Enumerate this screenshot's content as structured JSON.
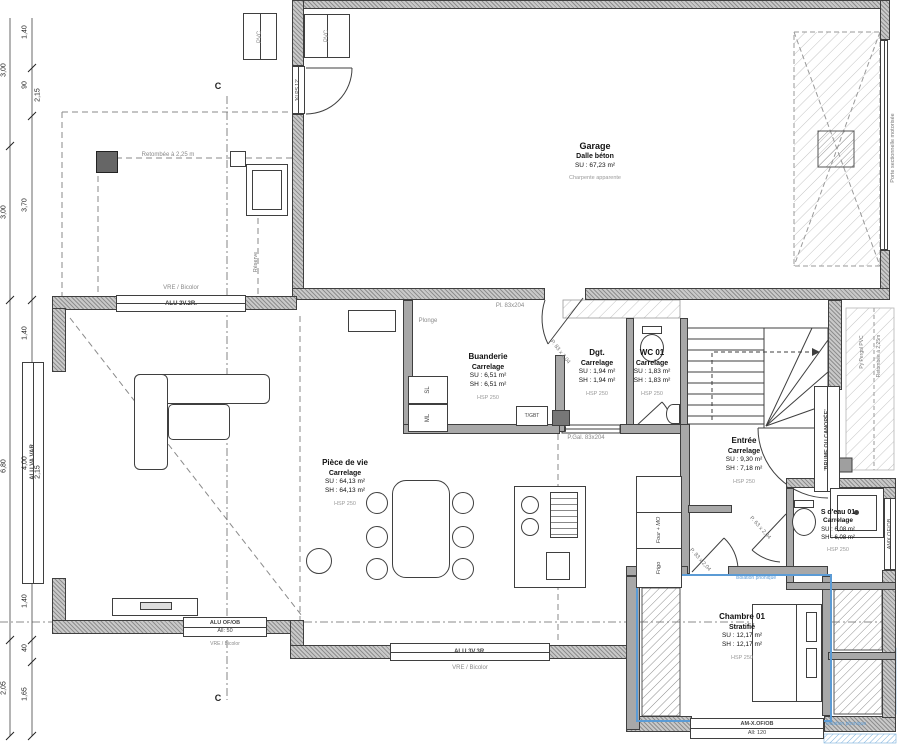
{
  "palette": {
    "wall_gray": "#a8a8a8",
    "line": "#3f3f3f",
    "accent_blue": "#5b9bd5",
    "hatch_gray": "#bdbdbd"
  },
  "rooms": [
    {
      "name": "Garage",
      "finish": "Dalle béton",
      "su": "SU : 67,23 m²",
      "note": "Charpente apparente"
    },
    {
      "name": "Pièce de vie",
      "finish": "Carrelage",
      "su": "SU : 64,13 m²",
      "sh": "SH : 64,13 m²",
      "hsp": "HSP 250"
    },
    {
      "name": "Buanderie",
      "finish": "Carrelage",
      "su": "SU : 6,51 m²",
      "sh": "SH : 6,51 m²",
      "hsp": "HSP 250"
    },
    {
      "name": "Dgt.",
      "finish": "Carrelage",
      "su": "SU : 1,94 m²",
      "sh": "SH : 1,94 m²",
      "hsp": "HSP 250"
    },
    {
      "name": "WC 01",
      "finish": "Carrelage",
      "su": "SU : 1,83 m²",
      "sh": "SH : 1,83 m²",
      "hsp": "HSP 250"
    },
    {
      "name": "Entrée",
      "finish": "Carrelage",
      "su": "SU : 9,30 m²",
      "sh": "SH : 7,18 m²",
      "hsp": "HSP 250"
    },
    {
      "name": "S d'eau 01",
      "finish": "Carrelage",
      "su": "SU : 6,08 m²",
      "sh": "SH : 6,08 m²",
      "hsp": "HSP 250"
    },
    {
      "name": "Chambre 01",
      "finish": "Stratifié",
      "su": "SU : 12,17 m²",
      "sh": "SH : 12,17 m²",
      "hsp": "HSP 250"
    }
  ],
  "openings": {
    "alu22": "ALU 2V.2R.",
    "alu33": "ALU 3V.3R.",
    "aluofob": "ALU OF/OB",
    "aluofob_sub": "All:  50",
    "amx": "AM-X.OF/OB",
    "amx_sub": "All:  120",
    "amx_side": "AMX OF/OB",
    "aluva": "ALU.VA VAR",
    "brume": "'BRUME OU CANOPÉE'",
    "pvc": "PVC",
    "klps": "'KLPS 12'",
    "vre": "VRE / Bicolor",
    "porte_sect": "Porte sectionnelle motorisée",
    "pgal": "P.Gal. 83x204",
    "pl83": "Pl. 83x204",
    "p83": "P. 83 x 2,04",
    "p63": "P. 63 x 2,04"
  },
  "annotations": {
    "retombee": "Retombée à 2,25 m",
    "reserve": "Réserve",
    "plonge": "Plonge",
    "pergola": "Py Pergol PVC",
    "retombee2": "Retombée à 2,25m",
    "iso": "isolation phonique",
    "section": "C"
  },
  "appliances": {
    "sl": "SL",
    "ml": "ML",
    "tgbt": "T/GBT",
    "four": "Four + MO",
    "frigo": "Frigo"
  },
  "dimensions": {
    "outer": [
      "3,00",
      "3,00",
      "6,80",
      "2,05"
    ],
    "inner": [
      "1,40",
      "90",
      "2,15",
      "3,70",
      "1,40",
      "4,00",
      "2,15",
      "1,40",
      "40",
      "1,65"
    ]
  }
}
